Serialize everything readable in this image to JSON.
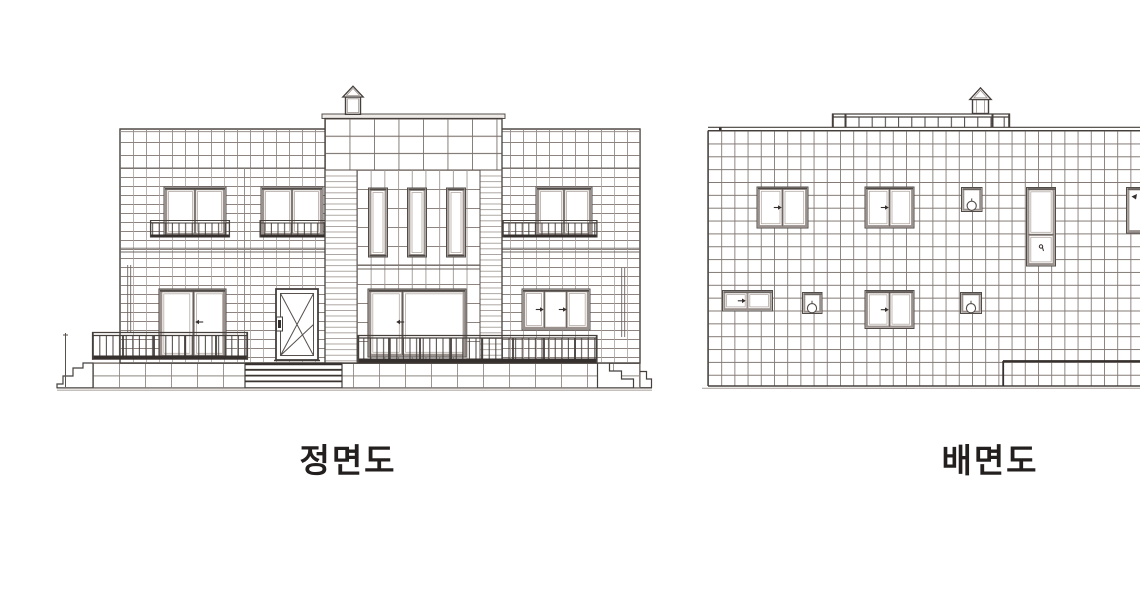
{
  "drawing": {
    "type": "architectural-elevation-drawing",
    "views": [
      {
        "id": "front-elevation",
        "label": "정면도",
        "components": [
          "chimney",
          "center tower",
          "upper windows with juliet railings",
          "three tall tower windows",
          "entrance door with cross bracing",
          "patio windows",
          "sliding window",
          "balcony railings",
          "entrance steps",
          "side steps"
        ]
      },
      {
        "id": "rear-elevation",
        "label": "배면도",
        "components": [
          "chimney",
          "roof deck railing",
          "double casement windows",
          "vent fan windows",
          "tall stair window",
          "partial right window",
          "lower terrace line"
        ]
      }
    ],
    "colors": {
      "background": "#ffffff",
      "outline": "#45403d",
      "tile_joint": "#9a918c",
      "frame_gray": "#9a918c",
      "dark_bar": "#352f2d",
      "text": "#231f1e"
    }
  }
}
